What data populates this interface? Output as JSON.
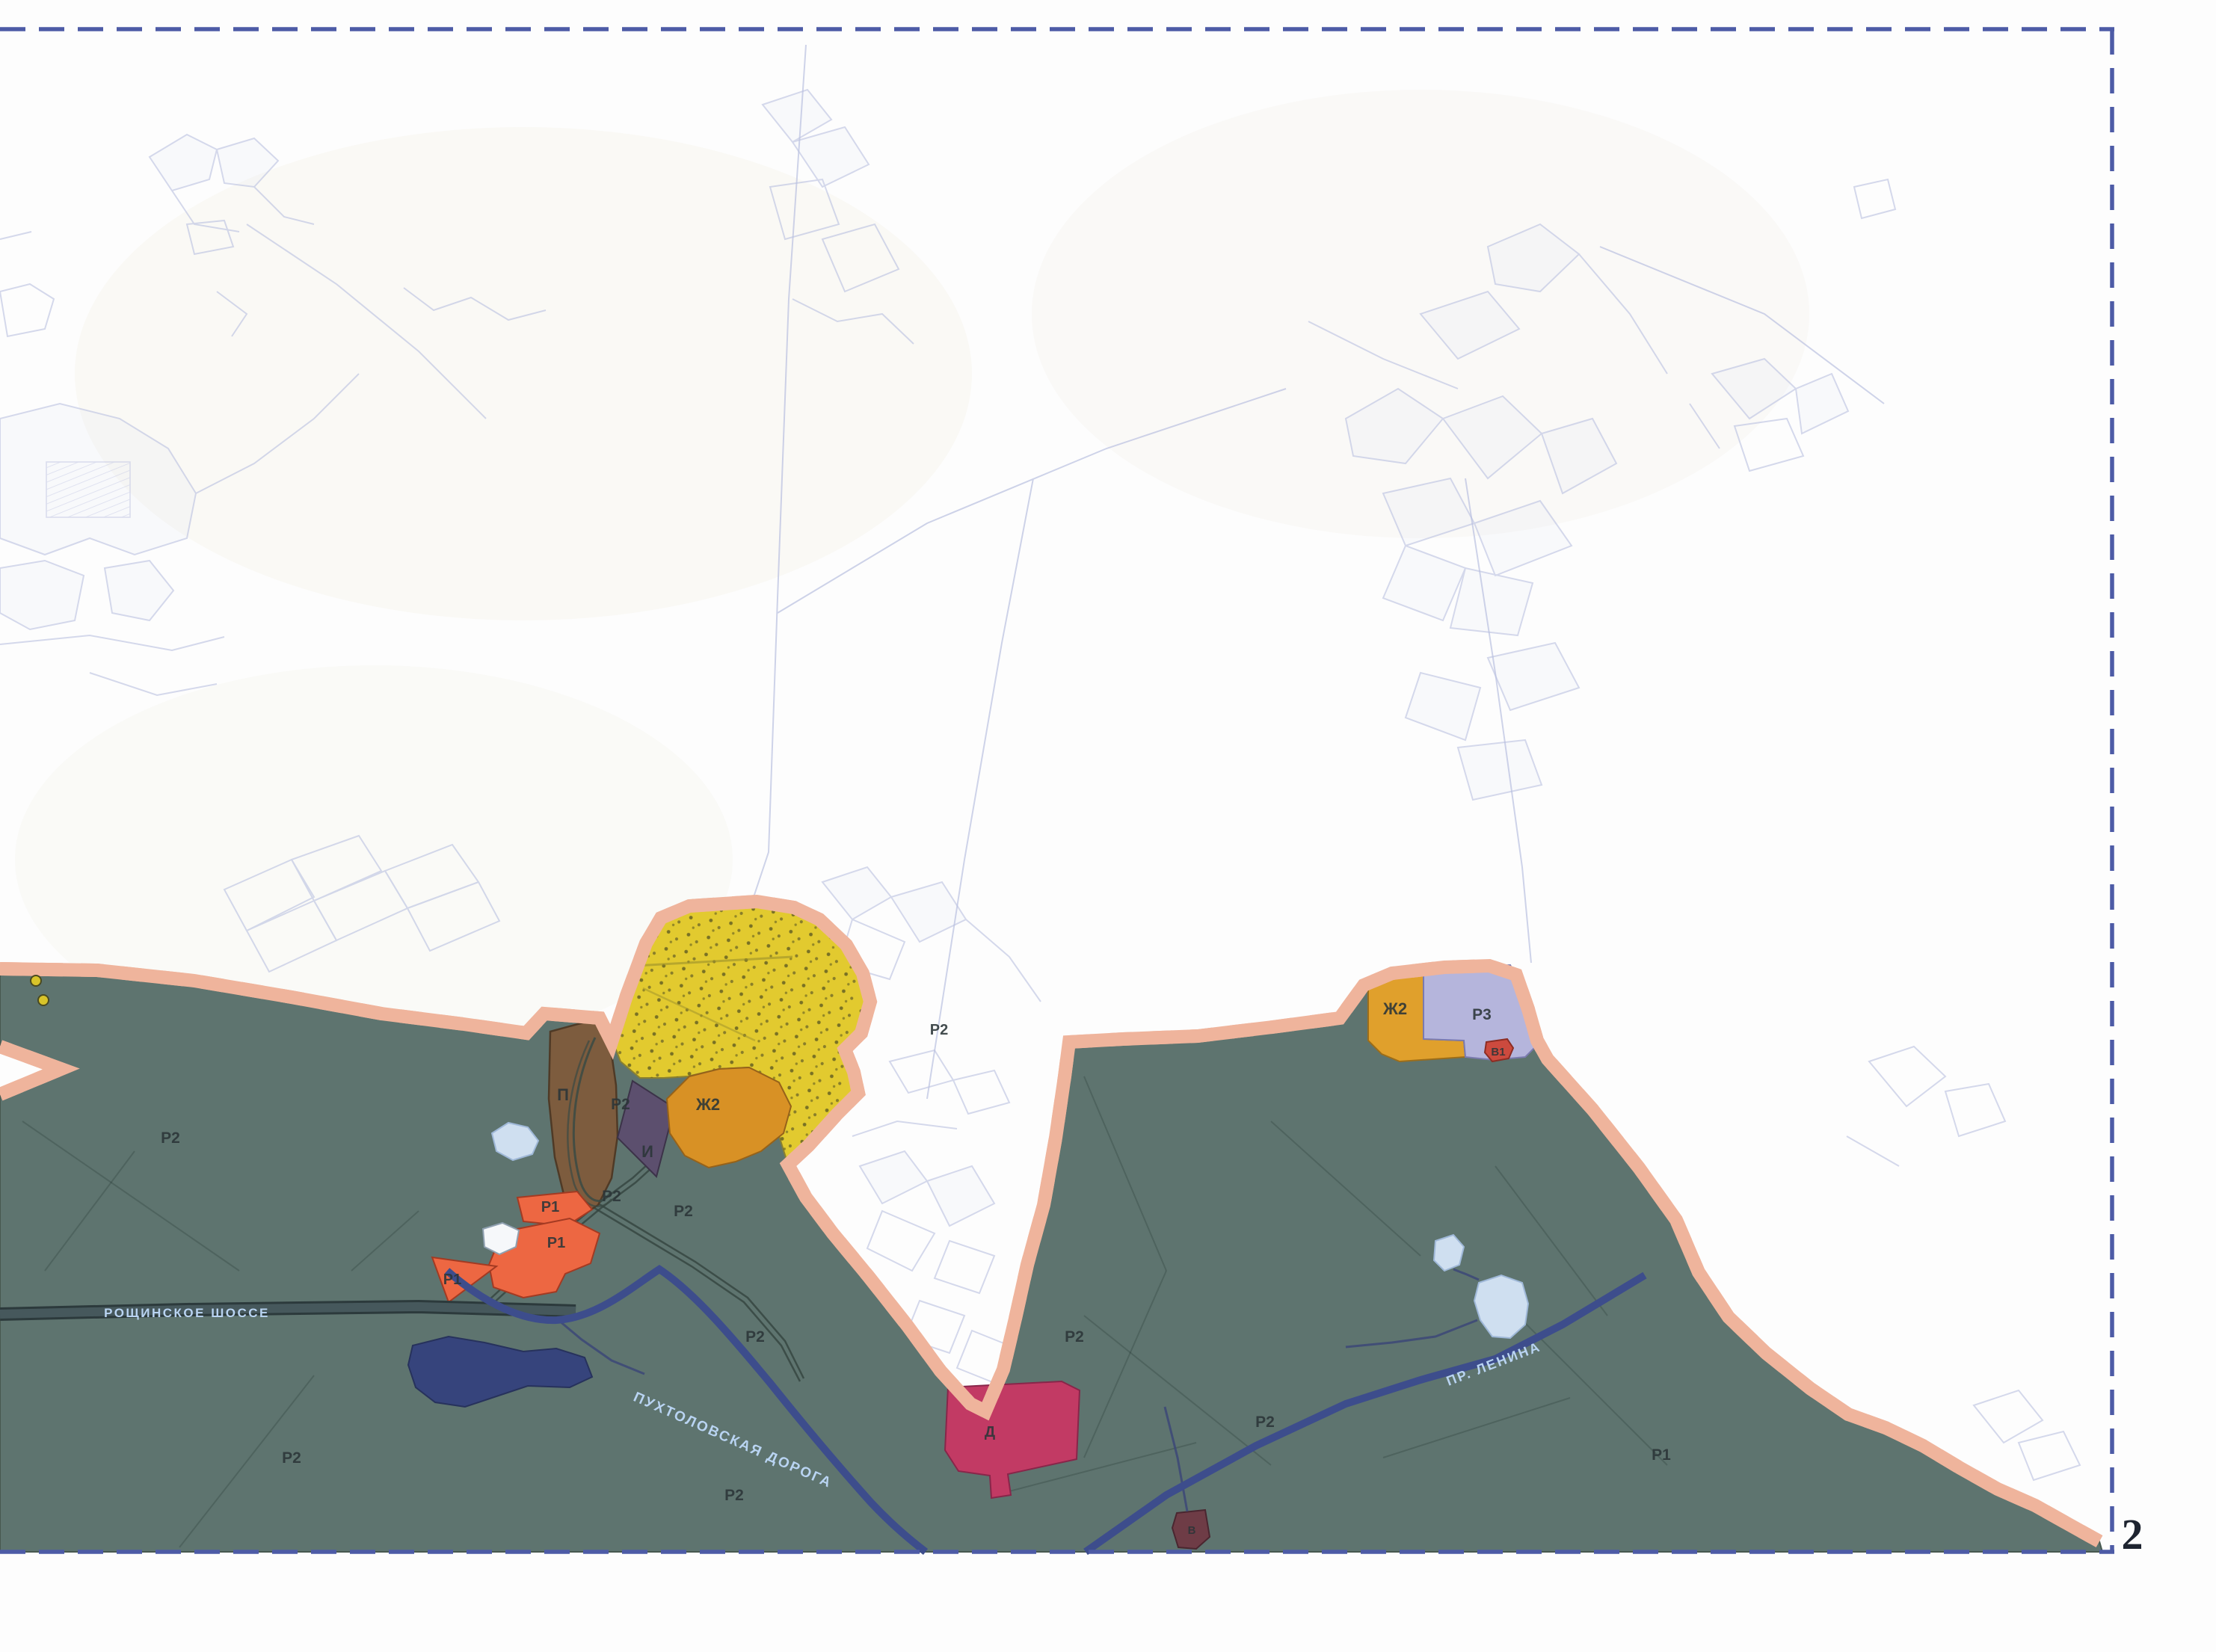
{
  "sheet": {
    "number": "2"
  },
  "road_labels": {
    "roshchinskoye": "РОЩИНСКОЕ ШОССЕ",
    "pukhtolovskaya": "ПУХТОЛОВСКАЯ ДОРОГА",
    "lenina": "ПР. ЛЕНИНА"
  },
  "zone_labels": [
    {
      "id": "p",
      "text": "П"
    },
    {
      "id": "i",
      "text": "И"
    },
    {
      "id": "zh2-west",
      "text": "Ж2"
    },
    {
      "id": "r2-a",
      "text": "Р2"
    },
    {
      "id": "r2-b",
      "text": "Р2"
    },
    {
      "id": "r2-c",
      "text": "Р2"
    },
    {
      "id": "r2-d",
      "text": "Р2"
    },
    {
      "id": "r2-e",
      "text": "Р2"
    },
    {
      "id": "r1-a",
      "text": "Р1"
    },
    {
      "id": "r1-b",
      "text": "Р1"
    },
    {
      "id": "r1-c",
      "text": "Р1"
    },
    {
      "id": "r2-f",
      "text": "Р2"
    },
    {
      "id": "r2-g",
      "text": "Р2"
    },
    {
      "id": "d",
      "text": "Д"
    },
    {
      "id": "v",
      "text": "В"
    },
    {
      "id": "r2-h",
      "text": "Р2"
    },
    {
      "id": "r2-i",
      "text": "Р2"
    },
    {
      "id": "r1-d",
      "text": "Р1"
    },
    {
      "id": "r2-j",
      "text": "Р2"
    },
    {
      "id": "zh2-east",
      "text": "Ж2"
    },
    {
      "id": "r3",
      "text": "Р3"
    },
    {
      "id": "v1",
      "text": "В1"
    }
  ],
  "colors": {
    "municipal_green": "#5e746f",
    "boundary_casing": "#efb49c",
    "boundary_dash": "#1f1f1f",
    "frame_dash": "#4d5ba6",
    "zone_yellow": "#e2ca2f",
    "zone_orange": "#d89125",
    "zone_brown": "#7d5c3e",
    "zone_purple": "#5c4f6e",
    "zone_red_orange": "#ed6742",
    "zone_lavender": "#b5b5dc",
    "zone_red_small": "#cc4a3e",
    "zone_crimson": "#c23a64",
    "zone_maroon": "#6e3c46",
    "road_navy": "#3d4d8c",
    "water_dark": "#36447c",
    "pond_light": "#cfdff0",
    "road_band": "#46585c",
    "cadastral_faint": "#b9c0e0"
  }
}
